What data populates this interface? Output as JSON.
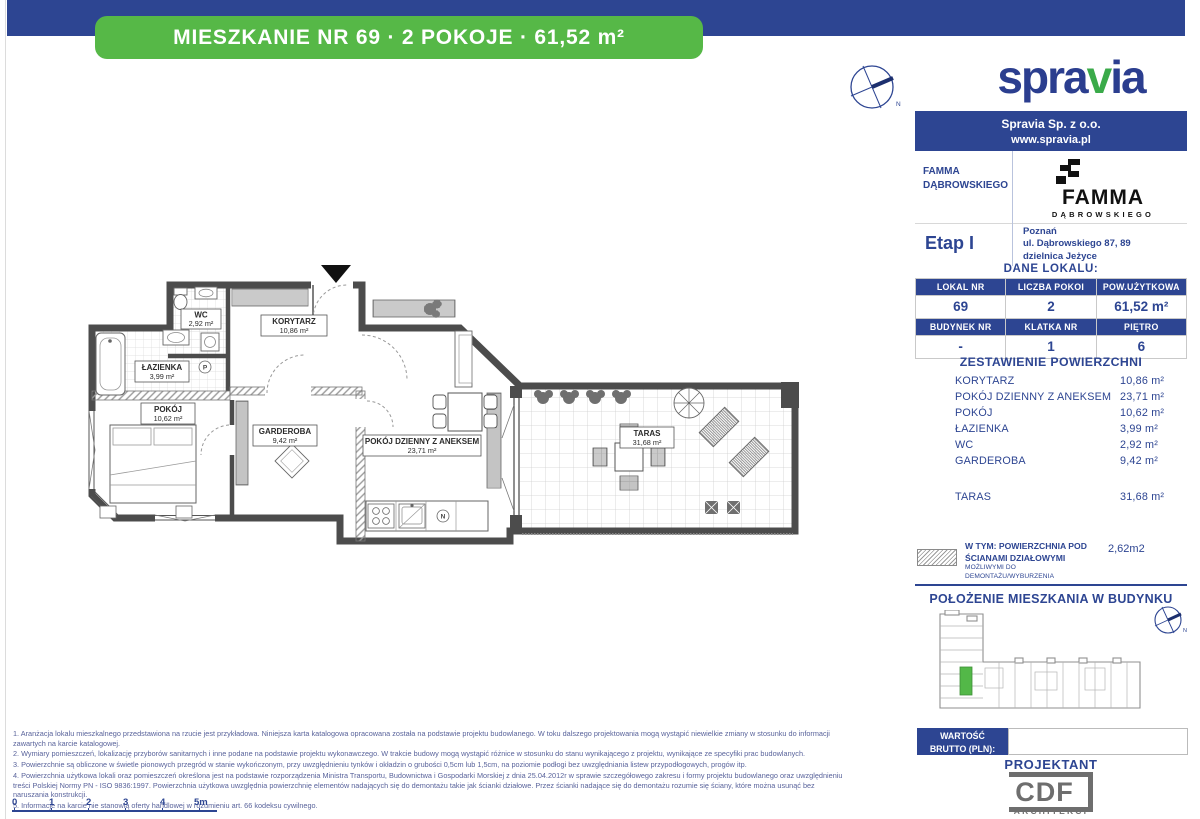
{
  "banner": {
    "title": "MIESZKANIE NR 69 · 2 POKOJE · 61,52 m²"
  },
  "brand": {
    "logo_pre": "spra",
    "logo_mid": "v",
    "logo_post": "ia",
    "company": "Spravia Sp. z o.o.",
    "website": "www.spravia.pl"
  },
  "compass": {
    "label": "N"
  },
  "project": {
    "name_line1": "FAMMA",
    "name_line2": "DĄBROWSKIEGO",
    "logo_title": "FAMMA",
    "logo_subtitle": "DĄBROWSKIEGO",
    "stage": "Etap I",
    "city": "Poznań",
    "street": "ul. Dąbrowskiego 87, 89",
    "district": "dzielnica Jeżyce"
  },
  "unit": {
    "heading": "DANE LOKALU:",
    "h1": [
      "LOKAL NR",
      "LICZBA POKOI",
      "POW.UŻYTKOWA"
    ],
    "v1": [
      "69",
      "2",
      "61,52 m²"
    ],
    "h2": [
      "BUDYNEK NR",
      "KLATKA NR",
      "PIĘTRO"
    ],
    "v2": [
      "-",
      "1",
      "6"
    ]
  },
  "areas": {
    "heading": "ZESTAWIENIE POWIERZCHNI",
    "items": [
      {
        "label": "KORYTARZ",
        "value": "10,86 m²"
      },
      {
        "label": "POKÓJ DZIENNY Z ANEKSEM",
        "value": "23,71 m²"
      },
      {
        "label": "POKÓJ",
        "value": "10,62 m²"
      },
      {
        "label": "ŁAZIENKA",
        "value": "3,99 m²"
      },
      {
        "label": "WC",
        "value": "2,92 m²"
      },
      {
        "label": "GARDEROBA",
        "value": "9,42 m²"
      }
    ],
    "terrace": {
      "label": "TARAS",
      "value": "31,68 m²"
    }
  },
  "partition": {
    "line1": "W TYM: POWIERZCHNIA POD",
    "line2": "ŚCIANAMI DZIAŁOWYMI",
    "line3": "MOŻLIWYMI DO DEMONTAŻU/WYBURZENIA",
    "value": "2,62m2"
  },
  "location": {
    "heading": "POŁOŻENIE MIESZKANIA W BUDYNKU"
  },
  "price": {
    "line1": "WARTOŚĆ",
    "line2": "BRUTTO (PLN):",
    "value": ""
  },
  "designer": {
    "heading": "PROJEKTANT",
    "logo": "CDF",
    "subtitle": "ARCHITEKCI"
  },
  "plan": {
    "rooms": {
      "wc": {
        "name": "WC",
        "area": "2,92 m²"
      },
      "korytarz": {
        "name": "KORYTARZ",
        "area": "10,86 m²"
      },
      "lazienka": {
        "name": "ŁAZIENKA",
        "area": "3,99 m²"
      },
      "pokoj": {
        "name": "POKÓJ",
        "area": "10,62 m²"
      },
      "garderoba": {
        "name": "GARDEROBA",
        "area": "9,42 m²"
      },
      "salon": {
        "name": "POKÓJ DZIENNY Z ANEKSEM",
        "area": "23,71 m²"
      },
      "taras": {
        "name": "TARAS",
        "area": "31,68 m²"
      }
    },
    "symbols": {
      "washer": "P",
      "vent": "N"
    }
  },
  "scalebar": {
    "labels": [
      "0",
      "1",
      "2",
      "3",
      "4",
      "5m"
    ]
  },
  "footnotes": [
    "1. Aranżacja lokalu mieszkalnego przedstawiona na rzucie jest przykładowa. Niniejsza karta katalogowa opracowana została na podstawie projektu budowlanego. W toku dalszego projektowania mogą wystąpić niewielkie zmiany w stosunku do informacji zawartych na karcie katalogowej.",
    "2. Wymiary pomieszczeń, lokalizację przyborów sanitarnych i inne podane na podstawie projektu wykonawczego. W trakcie budowy mogą wystąpić różnice w stosunku do stanu wynikającego z projektu, wynikające ze specyfiki prac budowlanych.",
    "3. Powierzchnie są obliczone w świetle pionowych przegród w stanie wykończonym, przy uwzględnieniu tynków i okładzin o grubości 0,5cm lub 1,5cm, na poziomie podłogi bez uwzględniania listew przypodłogowych, progów itp.",
    "4. Powierzchnia użytkowa lokali oraz pomieszczeń określona jest na podstawie rozporządzenia Ministra Transportu, Budownictwa i Gospodarki Morskiej z dnia 25.04.2012r w sprawie szczegółowego zakresu i formy projektu budowlanego oraz uwzględnieniu treści Polskiej Normy PN - ISO 9836:1997. Powierzchnia użytkowa uwzględnia powierzchnię elementów nadających się do demontażu takie jak ścianki działowe. Przez ścianki nadające się do demontażu rozumie się ściany, które można usunąć bez naruszania konstrukcji.",
    "5. Informacje na karcie nie stanowią oferty handlowej w rozumieniu art. 66 kodeksu cywilnego."
  ],
  "colors": {
    "blue": "#2d4592",
    "green": "#56b847",
    "logo_green": "#3aaa49",
    "black": "#111111",
    "gray": "#6e6e6e"
  }
}
